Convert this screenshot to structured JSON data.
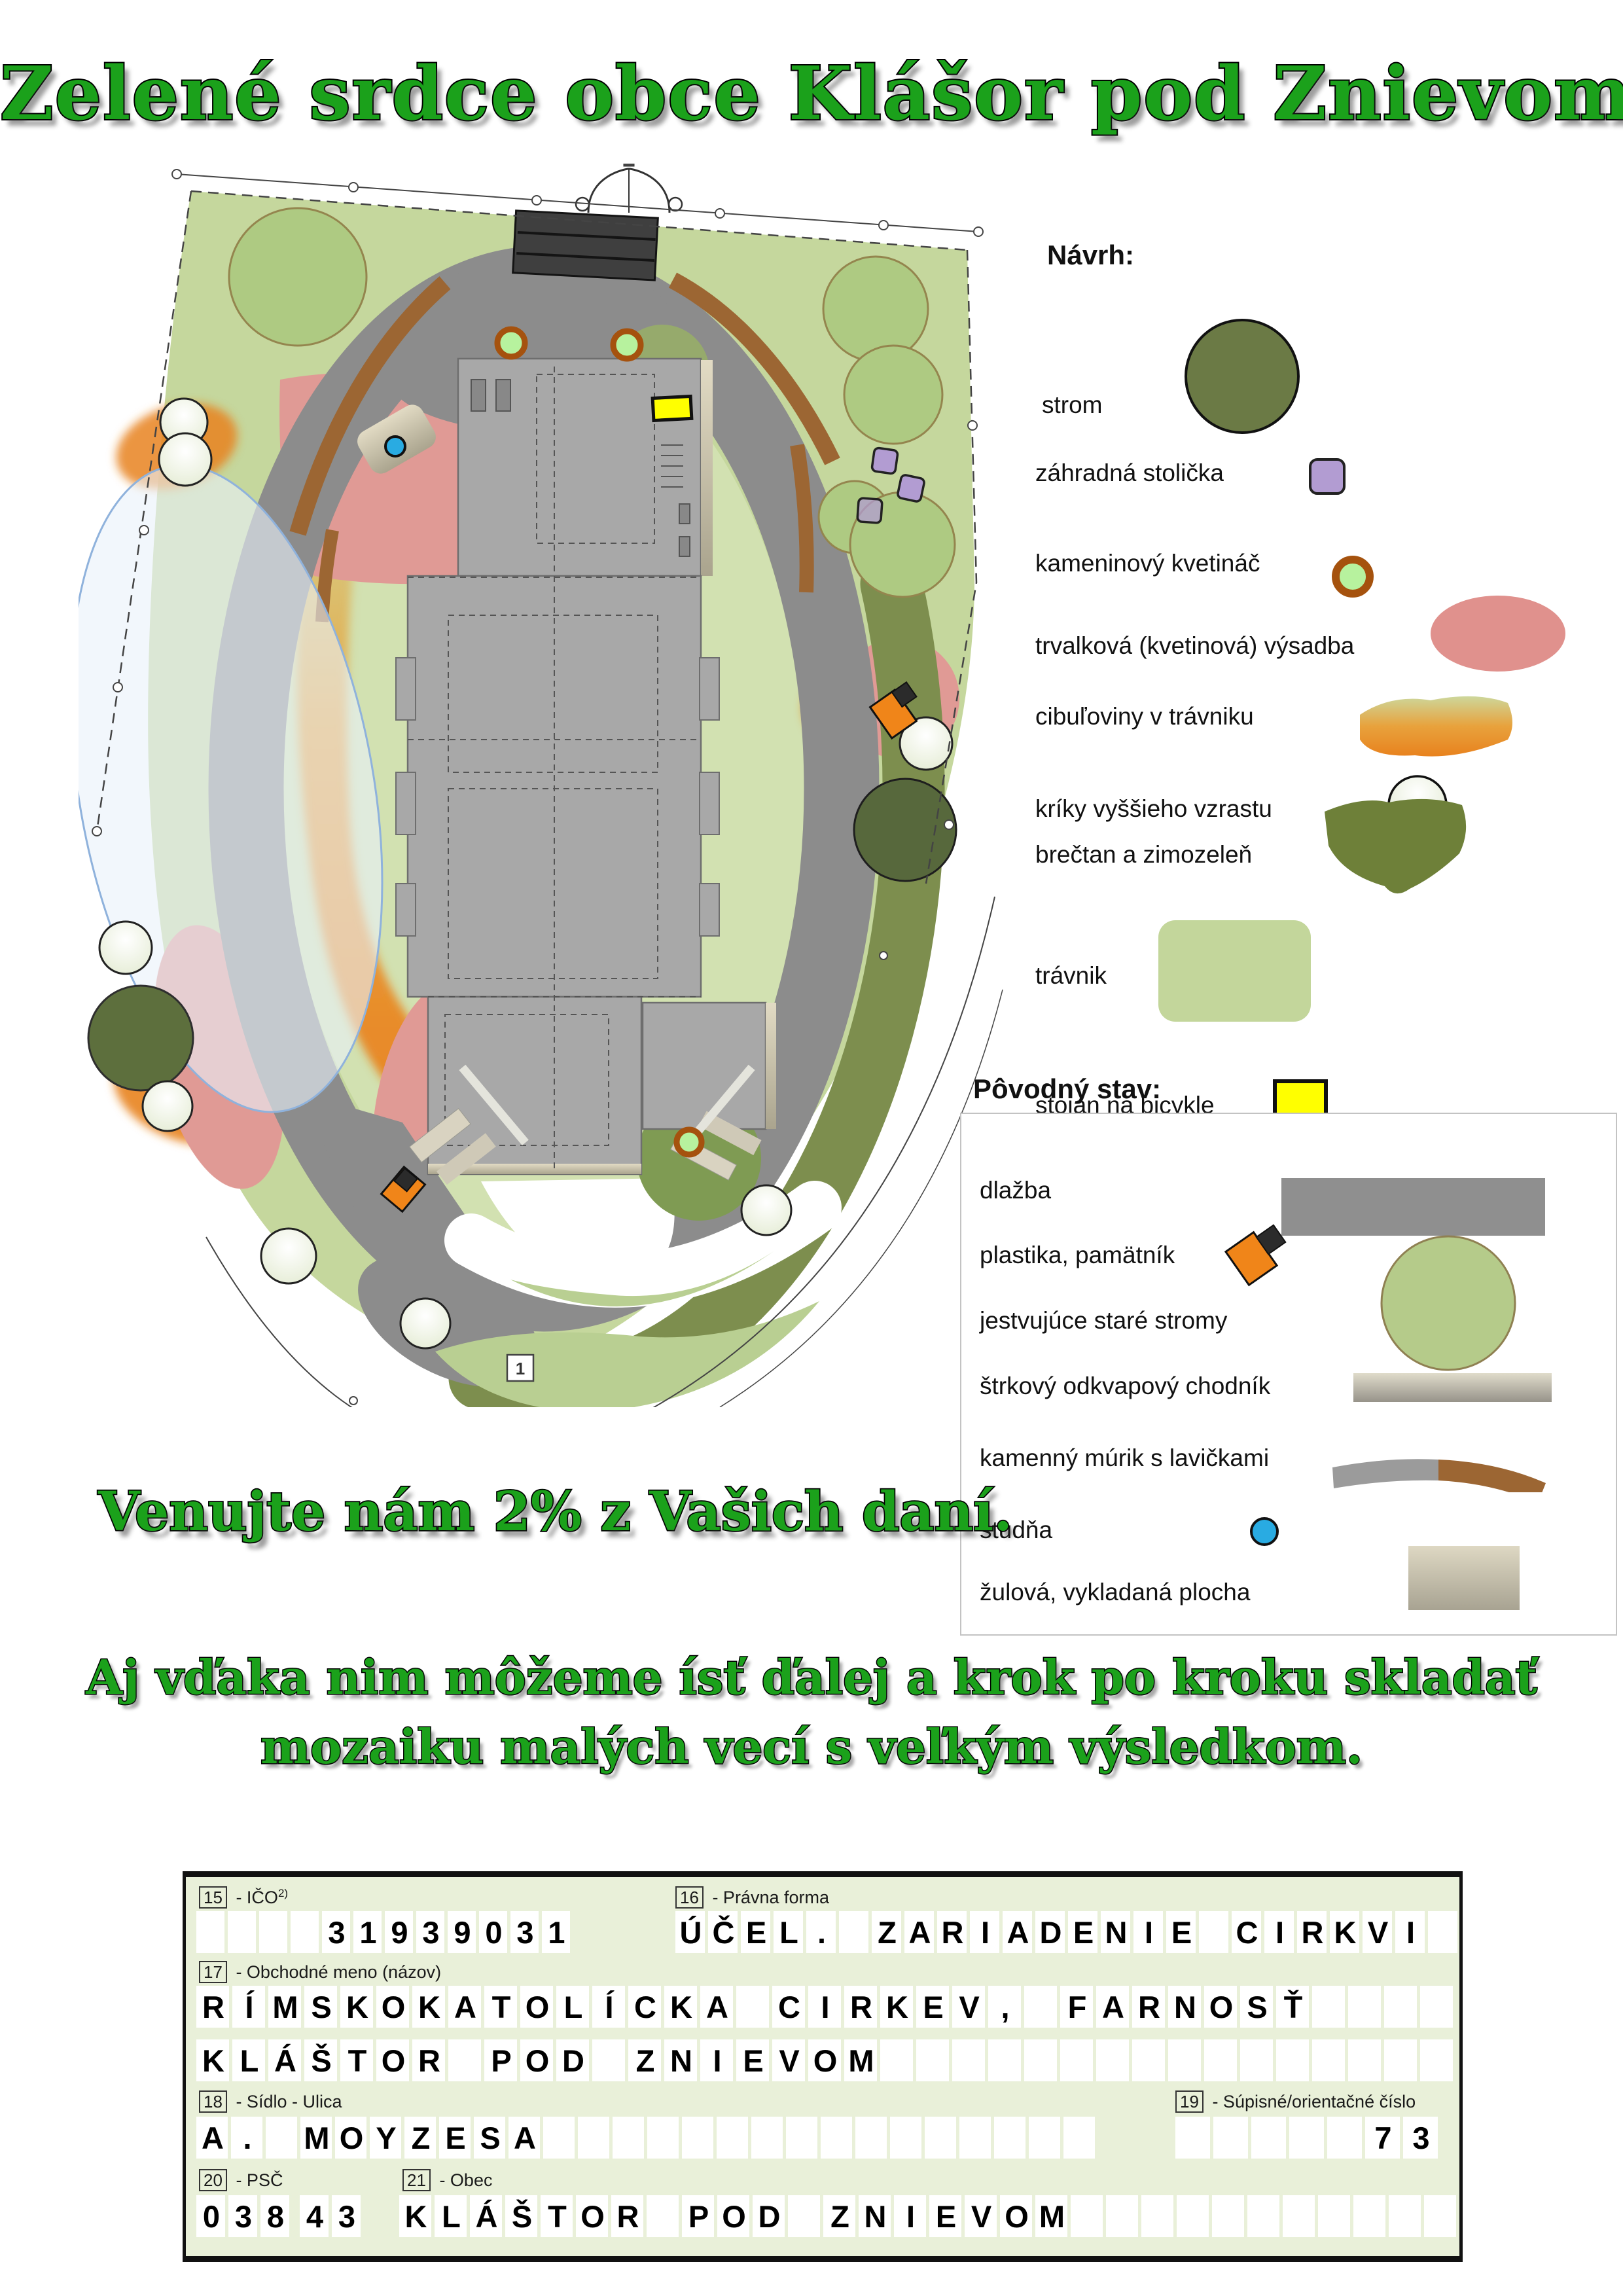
{
  "title": "Zelené srdce obce Klášor pod Znievom",
  "slogan_primary": "Venujte nám 2% z Vašich daní.",
  "slogan_secondary_line1": "Aj vďaka nim môžeme ísť ďalej a krok po kroku skladať",
  "slogan_secondary_line2": "mozaiku malých vecí s veľkým výsledkom.",
  "map": {
    "marker_label": "1",
    "colors": {
      "site_lawn_green": "#c5d79d",
      "path_gray": "#8c8c8c",
      "building_gray": "#a8a8a8",
      "stone_wall_brown": "#9c6633",
      "flowerbed_pink": "#e09a95",
      "bulbs_orange": "#e8831f",
      "irrigation_blue": "#e9f2fa",
      "tree_green": "#aeca82",
      "evergreen_dark": "#5d6f3d",
      "chair_purple": "#b29cd2",
      "bike_stand_yellow": "#ffff00",
      "well_blue": "#29abe2"
    }
  },
  "legend_navrh": {
    "title": "Návrh:",
    "items": [
      {
        "label": "strom",
        "icon": "tree-circle",
        "color": "#6b7a45"
      },
      {
        "label": "záhradná stolička",
        "icon": "garden-chair-square",
        "color": "#b29cd2"
      },
      {
        "label": "kameninový kvetináč",
        "icon": "flower-pot-circle",
        "color": "#b7f29e",
        "ring": "#a5520e"
      },
      {
        "label": "trvalková (kvetinová) výsadba",
        "icon": "perennial-bed-ellipse",
        "color": "#e0918d"
      },
      {
        "label": "cibuľoviny v trávniku",
        "icon": "bulbs-blob",
        "color": "#e8831f"
      },
      {
        "label": "kríky vyššieho vzrastu",
        "icon": "tall-shrub-circle",
        "color": "#f2f5e8"
      },
      {
        "label": "brečtan a zimozeleň",
        "icon": "ivy-blob",
        "color": "#6e8039"
      },
      {
        "label": "trávnik",
        "icon": "lawn-rect",
        "color": "#c3d69b"
      },
      {
        "label": "stojan na bicykle",
        "icon": "bike-stand-rect",
        "color": "#ffff00"
      },
      {
        "label": "závlahový systém",
        "icon": "irrigation-ellipse",
        "color": "#eaf3fb",
        "ring": "#85aede"
      }
    ]
  },
  "legend_povodny": {
    "title": "Pôvodný stav:",
    "items": [
      {
        "label": "dlažba",
        "icon": "paving-rect",
        "color": "#8f8f8f"
      },
      {
        "label": "plastika, pamätník",
        "icon": "memorial-diamonds",
        "color": "#f08519"
      },
      {
        "label": "jestvujúce staré stromy",
        "icon": "old-tree-circle",
        "color": "#b5cb8a"
      },
      {
        "label": "štrkový odkvapový chodník",
        "icon": "gravel-walk-bar",
        "color": "#c9c4b2"
      },
      {
        "label": "kamenný múrik s lavičkami",
        "icon": "stone-wall-band",
        "color": "#9c6633"
      },
      {
        "label": "studňa",
        "icon": "well-dot",
        "color": "#29abe2"
      },
      {
        "label": "žulová, vykladaná plocha",
        "icon": "granite-area-rect",
        "color": "#cfc9b4"
      }
    ]
  },
  "form": {
    "fields": {
      "ico": {
        "number": "15",
        "label": "- IČO",
        "sup": "2)",
        "value": "    31939031",
        "cells": 12
      },
      "pravna_forma": {
        "number": "16",
        "label": "- Právna forma",
        "value": "ÚČEL. ZARIADENIE CIRKVI",
        "cells": 24
      },
      "obchodne_meno": {
        "number": "17",
        "label": "- Obchodné meno (názov)",
        "value_line1": "RÍMSKOKATOLÍCKA CIRKEV, FARNOSŤ",
        "value_line2": "KLÁŠTOR POD ZNIEVOM",
        "cells": 35
      },
      "ulica": {
        "number": "18",
        "label": "- Sídlo - Ulica",
        "value": "A. MOYZESA",
        "cells": 26
      },
      "cislo": {
        "number": "19",
        "label": "- Súpisné/orientačné číslo",
        "value": "     73",
        "cells": 7
      },
      "psc": {
        "number": "20",
        "label": "- PSČ",
        "value": "03843",
        "cells": 5
      },
      "obec": {
        "number": "21",
        "label": "- Obec",
        "value": "KLÁŠTOR POD ZNIEVOM",
        "cells": 30
      }
    }
  }
}
